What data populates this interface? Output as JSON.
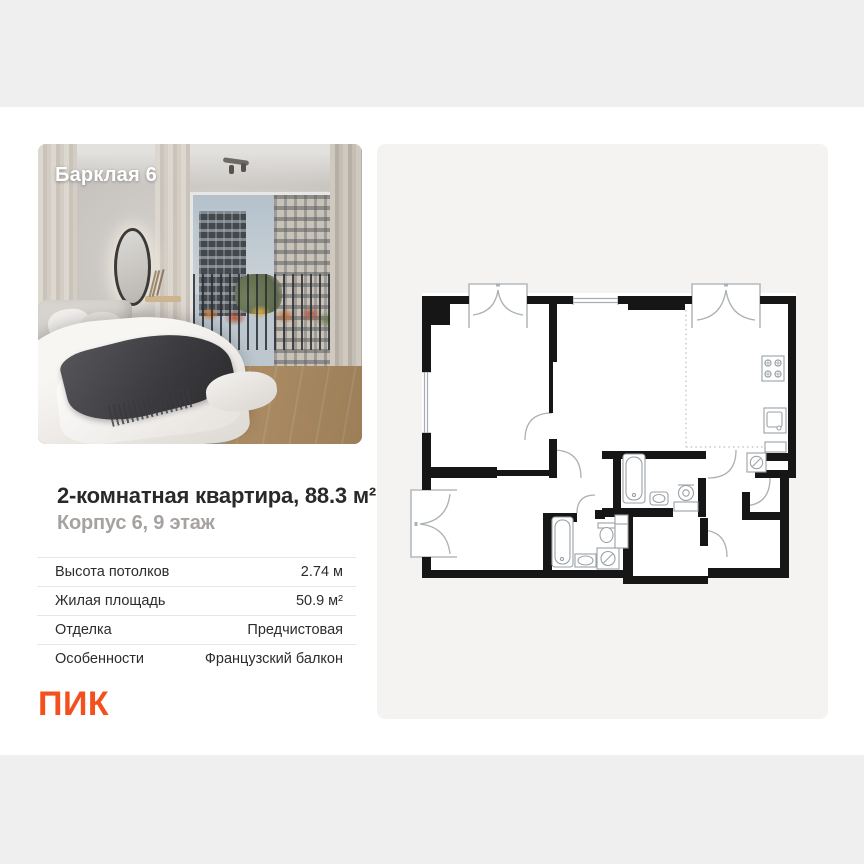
{
  "photo": {
    "project_name": "Барклая 6"
  },
  "listing": {
    "title": "2-комнатная квартира, 88.3 м²",
    "subtitle": "Корпус 6, 9 этаж"
  },
  "details": {
    "rows": [
      {
        "label": "Высота потолков",
        "value": "2.74 м"
      },
      {
        "label": "Жилая площадь",
        "value": "50.9 м²"
      },
      {
        "label": "Отделка",
        "value": "Предчистовая"
      },
      {
        "label": "Особенности",
        "value": "Французский балкон"
      }
    ]
  },
  "brand": {
    "logo_text": "ПИК",
    "accent_color": "#f4501e"
  },
  "colors": {
    "page_background": "#efefef",
    "card_background": "#ffffff",
    "plan_panel_background": "#f4f3f1",
    "plan_wall": "#161616",
    "subtitle_gray": "#a5a2a0"
  },
  "floor_plan": {
    "type": "2d-architectural-plan",
    "icons": [
      "stove-icon",
      "kitchen-sink-icon",
      "bathtub-icon",
      "toilet-icon",
      "washer-icon",
      "vanity-sink-icon",
      "french-balcony-doors",
      "door-swing-arcs",
      "dashed-kitchen-divider"
    ]
  }
}
